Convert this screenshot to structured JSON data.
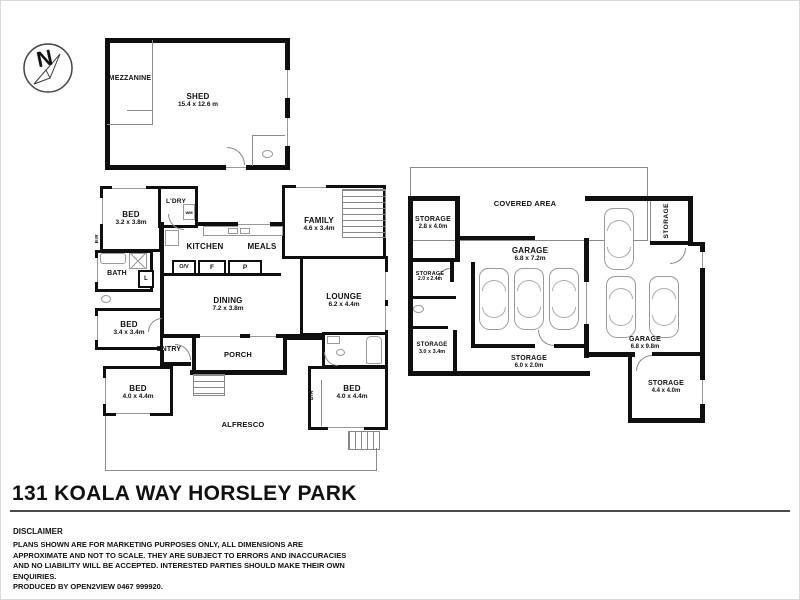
{
  "compass": {
    "label": "N"
  },
  "shed": {
    "mezzanine_label": "MEZZANINE",
    "name": "SHED",
    "dims": "15.4 x 12.6 m"
  },
  "house": {
    "bed_top": {
      "name": "BED",
      "dims": "3.2 x 3.8m"
    },
    "bir_top": {
      "name": "BIR"
    },
    "laundry": {
      "name": "L'DRY",
      "wm": "WM"
    },
    "kitchen": {
      "name": "KITCHEN"
    },
    "meals": {
      "name": "MEALS"
    },
    "family": {
      "name": "FAMILY",
      "dims": "4.6 x 3.4m"
    },
    "bath": {
      "name": "BATH"
    },
    "linen": {
      "name": "L"
    },
    "dining": {
      "name": "DINING",
      "dims": "7.2 x 3.8m"
    },
    "lounge": {
      "name": "LOUNGE",
      "dims": "6.2 x 4.4m"
    },
    "bed_mid": {
      "name": "BED",
      "dims": "3.4 x 3.4m"
    },
    "entry": {
      "name": "ENTRY"
    },
    "porch": {
      "name": "PORCH"
    },
    "bed_bottom_left": {
      "name": "BED",
      "dims": "4.0 x 4.4m"
    },
    "bed_bottom_right": {
      "name": "BED",
      "dims": "4.0 x 4.4m"
    },
    "bir_bottom": {
      "name": "BIR"
    },
    "alfresco": {
      "name": "ALFRESCO"
    },
    "appliances": {
      "oven": "O/V",
      "fridge": "F",
      "pantry": "P"
    }
  },
  "outbuilding": {
    "covered_area": {
      "name": "COVERED AREA"
    },
    "storage_top_left": {
      "name": "STORAGE",
      "dims": "2.8 x 4.0m"
    },
    "storage_small": {
      "name": "STORAGE",
      "dims": "2.0 x 2.4m"
    },
    "storage_mid_left": {
      "name": "STORAGE",
      "dims": "3.0 x 3.4m"
    },
    "garage_left": {
      "name": "GARAGE",
      "dims": "6.8 x 7.2m"
    },
    "garage_right": {
      "name": "GARAGE",
      "dims": "6.8 x 9.8m"
    },
    "storage_vertical": {
      "name": "STORAGE"
    },
    "storage_bottom": {
      "name": "STORAGE",
      "dims": "6.0 x 2.0m"
    },
    "storage_bottom_right": {
      "name": "STORAGE",
      "dims": "4.4 x 4.0m"
    }
  },
  "footer": {
    "title": "131 KOALA WAY HORSLEY PARK",
    "disclaimer_heading": "DISCLAIMER",
    "disclaimer_body": "PLANS SHOWN ARE FOR MARKETING PURPOSES ONLY, ALL DIMENSIONS ARE APPROXIMATE AND NOT TO SCALE. THEY ARE SUBJECT TO ERRORS AND INACCURACIES AND NO LIABILITY WILL BE ACCEPTED. INTERESTED PARTIES SHOULD MAKE THEIR OWN ENQUIRIES.",
    "produced_by": "PRODUCED BY OPEN2VIEW 0467 999920."
  },
  "colors": {
    "wall": "#0f0f0f",
    "thin_line": "#8a8a8a",
    "fixture_line": "#999999"
  }
}
